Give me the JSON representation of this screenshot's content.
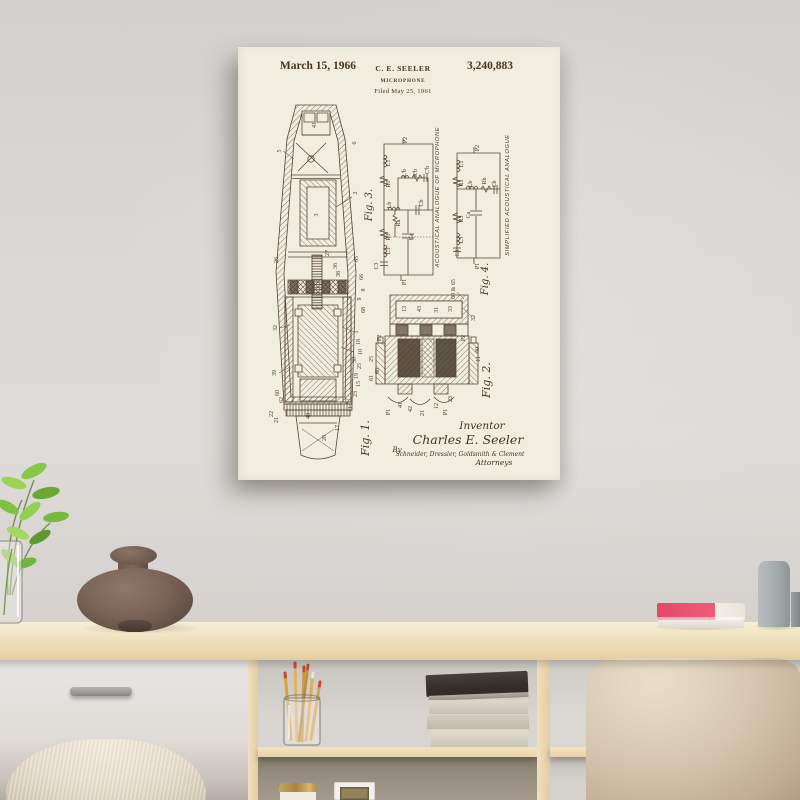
{
  "poster": {
    "header": {
      "date": "March 15, 1966",
      "inventor_name": "C. E. SEELER",
      "patent_number": "3,240,883",
      "title": "MICROPHONE",
      "filed_line": "Filed May 25, 1961"
    },
    "figures": {
      "fig1": {
        "label": "Fig. 1.",
        "refs": [
          {
            "t": "41",
            "x": 78,
            "y": 78
          },
          {
            "t": "5",
            "x": 43,
            "y": 104
          },
          {
            "t": "6",
            "x": 118,
            "y": 96
          },
          {
            "t": "2",
            "x": 119,
            "y": 146
          },
          {
            "t": "3",
            "x": 80,
            "y": 168
          },
          {
            "t": "26",
            "x": 40,
            "y": 213
          },
          {
            "t": "27",
            "x": 91,
            "y": 206
          },
          {
            "t": "36",
            "x": 99,
            "y": 219
          },
          {
            "t": "38",
            "x": 102,
            "y": 227
          },
          {
            "t": "65",
            "x": 120,
            "y": 212
          },
          {
            "t": "66",
            "x": 125,
            "y": 230
          },
          {
            "t": "8",
            "x": 127,
            "y": 243
          },
          {
            "t": "9",
            "x": 123,
            "y": 252
          },
          {
            "t": "68",
            "x": 127,
            "y": 263
          },
          {
            "t": "1",
            "x": 120,
            "y": 285
          },
          {
            "t": "18",
            "x": 122,
            "y": 295
          },
          {
            "t": "10",
            "x": 124,
            "y": 305
          },
          {
            "t": "30",
            "x": 118,
            "y": 313
          },
          {
            "t": "25",
            "x": 123,
            "y": 319
          },
          {
            "t": "19",
            "x": 120,
            "y": 329
          },
          {
            "t": "15",
            "x": 122,
            "y": 337
          },
          {
            "t": "23",
            "x": 119,
            "y": 347
          },
          {
            "t": "47",
            "x": 111,
            "y": 354
          },
          {
            "t": "11",
            "x": 114,
            "y": 362
          },
          {
            "t": "32",
            "x": 39,
            "y": 281
          },
          {
            "t": "39",
            "x": 38,
            "y": 326
          },
          {
            "t": "60",
            "x": 41,
            "y": 346
          },
          {
            "t": "62",
            "x": 45,
            "y": 353
          },
          {
            "t": "22",
            "x": 35,
            "y": 367
          },
          {
            "t": "21",
            "x": 40,
            "y": 373
          },
          {
            "t": "48",
            "x": 72,
            "y": 369
          },
          {
            "t": "28",
            "x": 88,
            "y": 391
          },
          {
            "t": "17",
            "x": 101,
            "y": 381
          }
        ]
      },
      "fig2": {
        "label": "Fig. 2.",
        "refs": [
          {
            "t": "43",
            "x": 183,
            "y": 262
          },
          {
            "t": "31",
            "x": 200,
            "y": 263
          },
          {
            "t": "32",
            "x": 237,
            "y": 271
          },
          {
            "t": "60 & 65",
            "x": 217,
            "y": 242,
            "s": 5
          },
          {
            "t": "13",
            "x": 168,
            "y": 262
          },
          {
            "t": "33",
            "x": 214,
            "y": 262
          },
          {
            "t": "P2",
            "x": 143,
            "y": 291,
            "s": 5.5
          },
          {
            "t": "P2",
            "x": 227,
            "y": 291,
            "s": 5.5
          },
          {
            "t": "40",
            "x": 241,
            "y": 303
          },
          {
            "t": "11",
            "x": 242,
            "y": 312
          },
          {
            "t": "25",
            "x": 135,
            "y": 312
          },
          {
            "t": "60",
            "x": 141,
            "y": 324
          },
          {
            "t": "61",
            "x": 135,
            "y": 331
          },
          {
            "t": "41",
            "x": 164,
            "y": 358
          },
          {
            "t": "42",
            "x": 174,
            "y": 362
          },
          {
            "t": "21",
            "x": 186,
            "y": 366
          },
          {
            "t": "12",
            "x": 200,
            "y": 359
          },
          {
            "t": "23",
            "x": 214,
            "y": 352
          },
          {
            "t": "P1",
            "x": 152,
            "y": 365,
            "s": 5.5
          },
          {
            "t": "P1",
            "x": 209,
            "y": 365,
            "s": 5.5
          }
        ]
      },
      "fig3": {
        "label": "Fig. 3.",
        "caption": "ACOUSTICAL ANALOGUE OF MICROPHONE",
        "refs": [
          {
            "t": "P2",
            "x": 169,
            "y": 93,
            "s": 5.5
          },
          {
            "t": "L1",
            "x": 152,
            "y": 116,
            "s": 5
          },
          {
            "t": "R1",
            "x": 152,
            "y": 137,
            "s": 5
          },
          {
            "t": "L'b",
            "x": 168,
            "y": 126,
            "s": 5
          },
          {
            "t": "R'b",
            "x": 179,
            "y": 126,
            "s": 5
          },
          {
            "t": "C'b",
            "x": 191,
            "y": 123,
            "s": 5
          },
          {
            "t": "Lb",
            "x": 153,
            "y": 158,
            "s": 5
          },
          {
            "t": "Cb",
            "x": 185,
            "y": 156,
            "s": 5
          },
          {
            "t": "Ra",
            "x": 162,
            "y": 176,
            "s": 5
          },
          {
            "t": "R3",
            "x": 152,
            "y": 190,
            "s": 5
          },
          {
            "t": "Ca",
            "x": 175,
            "y": 190,
            "s": 5
          },
          {
            "t": "L3",
            "x": 152,
            "y": 204,
            "s": 5
          },
          {
            "t": "C3",
            "x": 140,
            "y": 219,
            "s": 5
          },
          {
            "t": "P1",
            "x": 168,
            "y": 235,
            "s": 5.5
          }
        ]
      },
      "fig4": {
        "label": "Fig. 4.",
        "caption": "SIMPLIFIED ACOUSTICAL ANALOGUE",
        "refs": [
          {
            "t": "P2",
            "x": 241,
            "y": 101,
            "s": 5.5
          },
          {
            "t": "L1",
            "x": 225,
            "y": 117,
            "s": 5
          },
          {
            "t": "R1",
            "x": 225,
            "y": 136,
            "s": 5
          },
          {
            "t": "Lb",
            "x": 234,
            "y": 137,
            "s": 5
          },
          {
            "t": "Rb",
            "x": 248,
            "y": 134,
            "s": 5
          },
          {
            "t": "Cb",
            "x": 258,
            "y": 137,
            "s": 5
          },
          {
            "t": "Ca",
            "x": 232,
            "y": 168,
            "s": 5
          },
          {
            "t": "R3",
            "x": 225,
            "y": 172,
            "s": 5
          },
          {
            "t": "L3",
            "x": 225,
            "y": 193,
            "s": 5
          },
          {
            "t": "C3",
            "x": 221,
            "y": 206,
            "s": 5
          },
          {
            "t": "P1",
            "x": 241,
            "y": 219,
            "s": 5.5
          }
        ]
      }
    },
    "signature": {
      "inventor_label": "Inventor",
      "inventor_name": "Charles E. Seeler",
      "by_label": "By",
      "firm": "Schneider, Dressler, Goldsmith & Clement",
      "attorneys_label": "Attorneys"
    },
    "colors": {
      "paper": "#f1eee0",
      "ink": "#4a3929"
    }
  },
  "scene": {
    "colors": {
      "wall": "#d9d6d3",
      "wood": "#efdfbc",
      "drawer": "#e3e1df",
      "velvet_pouf": "#d6c5af",
      "knit_pouf": "#e8e0d0",
      "brown_vase": "#74604f",
      "plant_green": "#7fc142",
      "pink_book": "#e8516f",
      "gray_vase": "#a9aeb0"
    }
  }
}
